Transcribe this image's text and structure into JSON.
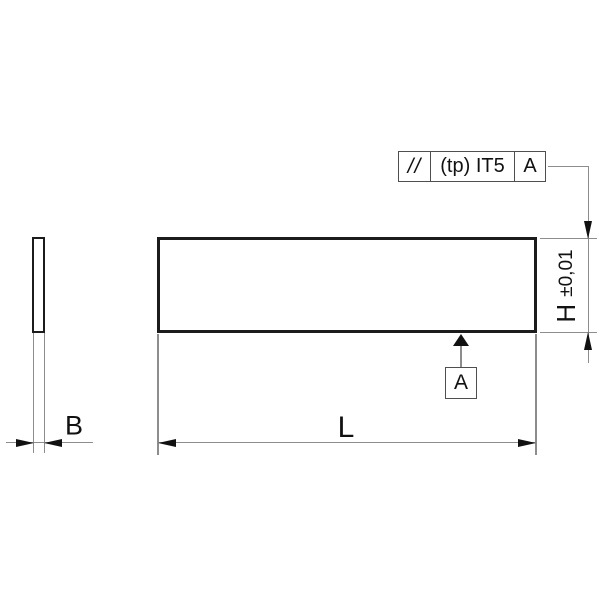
{
  "feature_control_frame": {
    "symbol": "//",
    "symbol_meaning": "parallelism",
    "tolerance": "(tp) IT5",
    "datum": "A"
  },
  "datum": {
    "label": "A"
  },
  "dimensions": {
    "length": {
      "label": "L"
    },
    "width": {
      "label": "B"
    },
    "height": {
      "label": "H",
      "tolerance": "±0,01"
    }
  },
  "colors": {
    "outline": "#1c1c1c",
    "thin": "#8d8d8d",
    "frame": "#4f4f4f",
    "ink": "#111111",
    "bg": "#ffffff"
  }
}
